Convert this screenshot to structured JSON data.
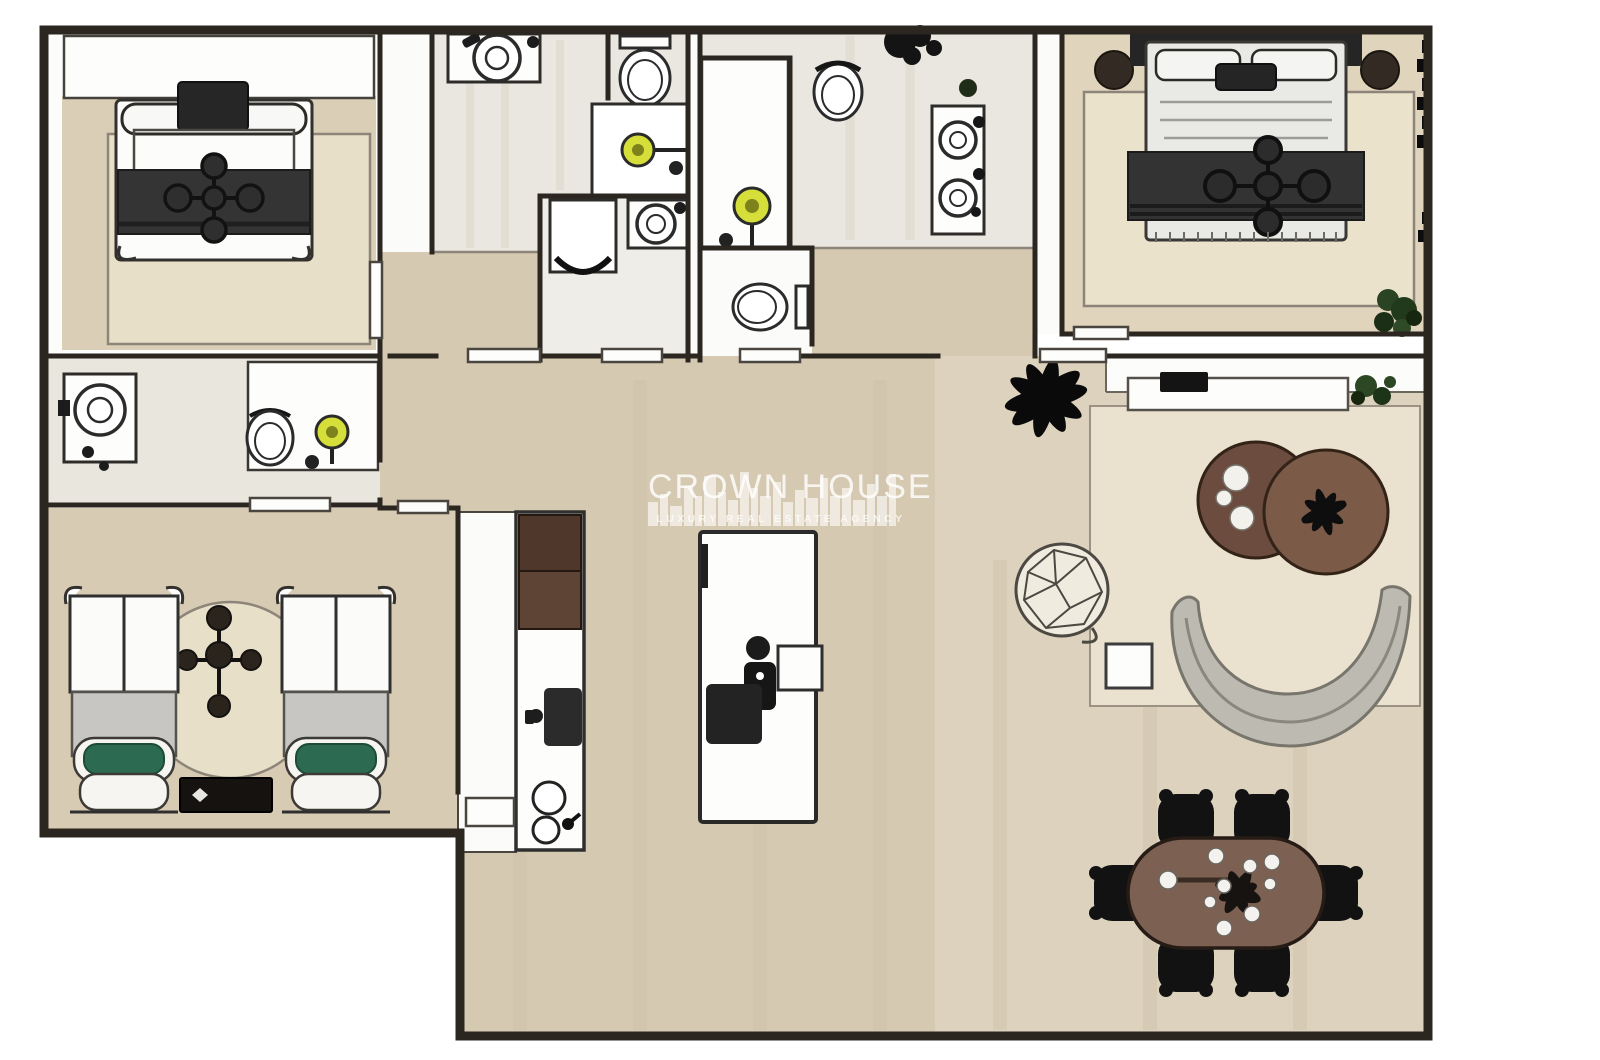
{
  "watermark": {
    "title": "CROWN HOUSE",
    "subtitle": "LUXURY REAL ESTATE AGENCY"
  },
  "palette": {
    "wall": "#2b2620",
    "outside": "#ffffff",
    "floor_tan": "#dbceb6",
    "floor_marble": "#eae7e0",
    "floor_corridor": "#d6c9b1",
    "floor_living": "#ddd2bd",
    "rug_cream": "#e8dfc8",
    "rug_living": "#eae1cf",
    "furniture_dark": "#2b2b2b",
    "sheet_gray": "#c7c6c2",
    "cushion_green": "#2c6b52",
    "cabinet_brown": "#5d4434",
    "table_brown": "#7c6052",
    "coffee_table_brown": "#6b4c3e",
    "sofa_gray": "#bdbbb1",
    "shower_yellow": "#d6df3a",
    "plant_green": "#2a4423",
    "plant_black": "#0a0a0a"
  },
  "floor_plan": {
    "type": "apartment-top-view",
    "rooms": [
      {
        "name": "bedroom-top-left",
        "furniture": [
          "closet",
          "double-bed",
          "area-rug"
        ]
      },
      {
        "name": "bathroom-top-middle",
        "furniture": [
          "vanity-sink",
          "toilet",
          "shower",
          "washing-machine",
          "second-vanity-sink"
        ]
      },
      {
        "name": "bathroom-top-center",
        "furniture": [
          "shower",
          "toilet",
          "double-vanity",
          "plants",
          "wc-toilet"
        ]
      },
      {
        "name": "master-bedroom",
        "furniture": [
          "double-bed",
          "round-side-table-left",
          "round-side-table-right",
          "area-rug",
          "plant",
          "curtain"
        ]
      },
      {
        "name": "bathroom-left",
        "furniture": [
          "vanity-sink",
          "toilet",
          "shower"
        ]
      },
      {
        "name": "twin-bedroom",
        "furniture": [
          "single-bed-left",
          "single-bed-right",
          "round-rug",
          "ceiling-fan",
          "nightstand"
        ]
      },
      {
        "name": "kitchen",
        "furniture": [
          "cabinet-run",
          "cooktop",
          "double-sink",
          "island"
        ]
      },
      {
        "name": "living-room",
        "furniture": [
          "palm-plant",
          "media-console",
          "tv",
          "console-plant",
          "wire-lounge-chair",
          "side-table",
          "coffee-table-left",
          "coffee-table-right",
          "curved-sofa",
          "area-rug"
        ]
      },
      {
        "name": "dining-area",
        "furniture": [
          "oval-table",
          "chair-1",
          "chair-2",
          "chair-3",
          "chair-4",
          "chair-5",
          "chair-6",
          "centerpiece"
        ]
      }
    ]
  }
}
